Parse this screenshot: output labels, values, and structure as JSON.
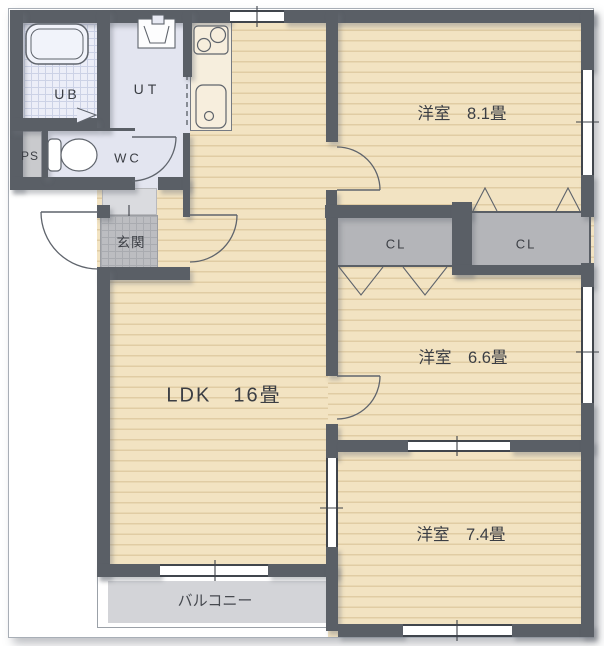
{
  "plan": {
    "rooms": {
      "ub": {
        "label": "UB"
      },
      "ut": {
        "label": "UT"
      },
      "ps": {
        "label": "PS"
      },
      "wc": {
        "label": "WC"
      },
      "genkan": {
        "label": "玄関"
      },
      "ldk": {
        "label": "LDK　16畳"
      },
      "bedroom1": {
        "label": "洋室　8.1畳"
      },
      "bedroom2": {
        "label": "洋室　6.6畳"
      },
      "bedroom3": {
        "label": "洋室　7.4畳"
      },
      "closet_left": {
        "label": "CL"
      },
      "closet_right": {
        "label": "CL"
      },
      "balcony": {
        "label": "バルコニー"
      }
    },
    "colors": {
      "wall": "#5a5f66",
      "floor": "#f2e3c2",
      "floor_stripe": "#e0cca4",
      "tile_area": "#e3e5f0",
      "ub_tile": "#eceef8",
      "closet": "#b4b5b9",
      "genkan_tile": "#bcbdc1",
      "doormat": "#dadbdf",
      "balcony": "#d3d4d8",
      "pipe_space": "#c9cacd",
      "line": "#40454c"
    }
  }
}
